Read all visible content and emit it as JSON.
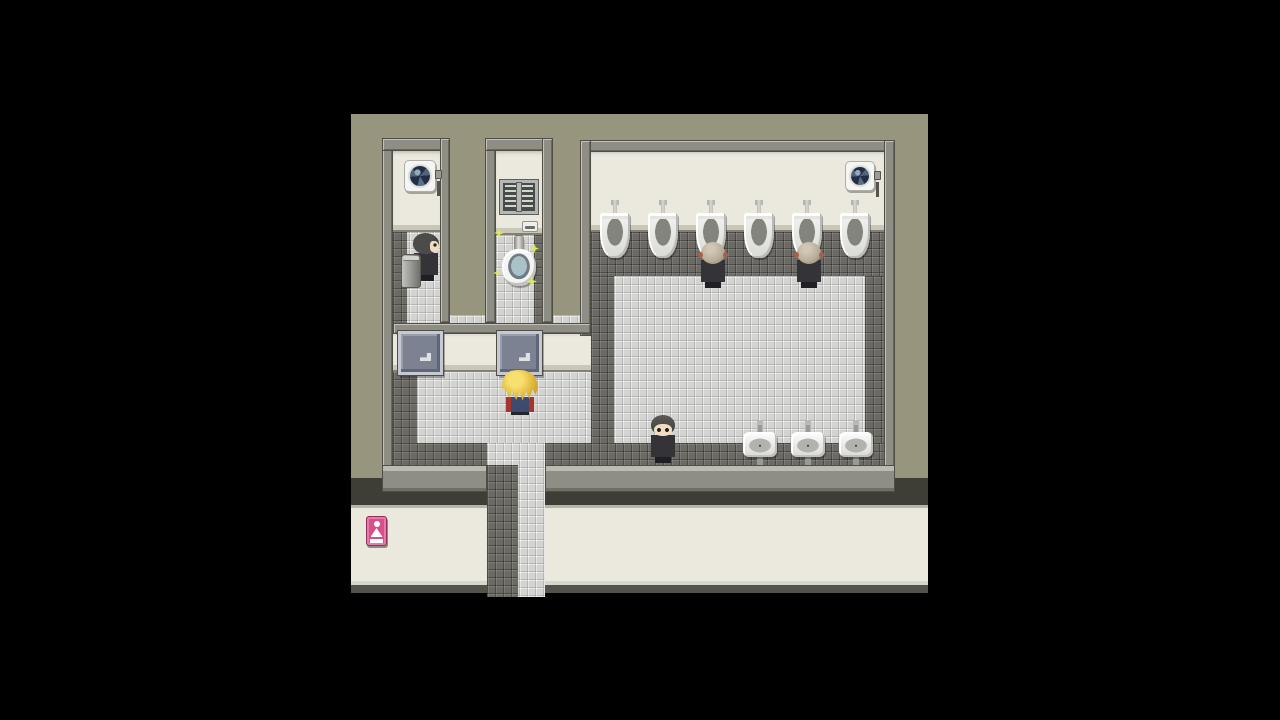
{
  "scene": {
    "viewport": {
      "x": 351,
      "y": 114,
      "w": 577,
      "h": 483
    },
    "palette": {
      "bg": "#000000",
      "olive": "#97957d",
      "wall": "#8f8e84",
      "cream": "#ebe8de",
      "creamShade": "#c9c6ba",
      "tileLight": "#d3d3d1",
      "tileDark": "#6b6a64",
      "doorFill": "#7d8292",
      "doorFrame": "#c6c9d1",
      "pink": "#d84f8a",
      "fixture": "#9b9b95",
      "skin": "#f2dcc2",
      "suit": "#333338",
      "hairBald": "#b6ab99",
      "playerHair": "#e2b93f",
      "playerSuit": "#3c4b6e",
      "accentRed": "#a8342e",
      "sparkle": "#dfe75a"
    },
    "elements": [
      {
        "type": "shadow-band",
        "name": "exterior-shadow",
        "x": 0,
        "y": 364,
        "w": 577,
        "h": 27,
        "interactable": false
      },
      {
        "type": "hall-wall",
        "name": "hallway-wall",
        "x": 0,
        "y": 391,
        "w": 577,
        "h": 80,
        "interactable": false
      },
      {
        "type": "hall-dark-strip",
        "name": "hallway-floor-edge",
        "x": 0,
        "y": 471,
        "w": 577,
        "h": 8,
        "interactable": false
      },
      {
        "type": "black-strip",
        "name": "hallway-darkness",
        "x": 0,
        "y": 479,
        "w": 577,
        "h": 4,
        "interactable": false
      },
      {
        "type": "tile-light",
        "name": "corridor-floor",
        "x": 136,
        "y": 329,
        "w": 58,
        "h": 154,
        "interactable": false
      },
      {
        "type": "tile-dark",
        "name": "corridor-floor-dark",
        "x": 136,
        "y": 351,
        "w": 31,
        "h": 132,
        "interactable": false
      },
      {
        "type": "tile-light",
        "name": "entry-area-floor",
        "x": 66,
        "y": 201,
        "w": 174,
        "h": 128,
        "interactable": false
      },
      {
        "type": "tile-dark",
        "name": "entry-floor-left-border",
        "x": 42,
        "y": 201,
        "w": 24,
        "h": 150,
        "interactable": false
      },
      {
        "type": "tile-dark",
        "name": "entry-floor-bottom-border",
        "x": 66,
        "y": 329,
        "w": 70,
        "h": 22,
        "interactable": false
      },
      {
        "type": "tile-dark",
        "name": "corridor-right-border",
        "x": 194,
        "y": 329,
        "w": 46,
        "h": 22,
        "interactable": false
      },
      {
        "type": "tile-light",
        "name": "stall1-floor",
        "x": 42,
        "y": 118,
        "w": 47,
        "h": 91,
        "interactable": false
      },
      {
        "type": "tile-dark",
        "name": "stall1-floor-border",
        "x": 42,
        "y": 118,
        "w": 14,
        "h": 91,
        "interactable": false
      },
      {
        "type": "tile-light",
        "name": "stall2-floor",
        "x": 145,
        "y": 121,
        "w": 46,
        "h": 88,
        "interactable": false
      },
      {
        "type": "tile-dark",
        "name": "stall2-floor-border",
        "x": 183,
        "y": 121,
        "w": 8,
        "h": 88,
        "interactable": false
      },
      {
        "type": "tile-dark",
        "name": "mainroom-floor-top-border",
        "x": 240,
        "y": 118,
        "w": 293,
        "h": 44,
        "interactable": false
      },
      {
        "type": "tile-dark",
        "name": "mainroom-floor-left-border",
        "x": 240,
        "y": 162,
        "w": 23,
        "h": 189,
        "interactable": false
      },
      {
        "type": "tile-dark",
        "name": "mainroom-floor-right-border",
        "x": 514,
        "y": 162,
        "w": 19,
        "h": 189,
        "interactable": false
      },
      {
        "type": "tile-dark",
        "name": "mainroom-floor-bottom-border",
        "x": 240,
        "y": 329,
        "w": 293,
        "h": 22,
        "interactable": false
      },
      {
        "type": "tile-light",
        "name": "mainroom-floor",
        "x": 263,
        "y": 162,
        "w": 251,
        "h": 167,
        "interactable": false
      },
      {
        "type": "cream",
        "name": "stall1-back-wall",
        "x": 42,
        "y": 37,
        "w": 47,
        "h": 81,
        "interactable": false
      },
      {
        "type": "cream",
        "name": "stall2-back-wall",
        "x": 145,
        "y": 37,
        "w": 46,
        "h": 84,
        "interactable": false
      },
      {
        "type": "cream",
        "name": "mainroom-back-wall",
        "x": 240,
        "y": 37,
        "w": 293,
        "h": 81,
        "interactable": false
      },
      {
        "type": "cream",
        "name": "stall-front-wall",
        "x": 42,
        "y": 218,
        "w": 198,
        "h": 40,
        "interactable": false
      },
      {
        "type": "wall",
        "name": "outer-wall-left",
        "x": 31,
        "y": 24,
        "w": 11,
        "h": 354,
        "interactable": false
      },
      {
        "type": "wall",
        "name": "stall1-wall-top",
        "x": 31,
        "y": 24,
        "w": 68,
        "h": 13,
        "interactable": false
      },
      {
        "type": "wall",
        "name": "stall1-wall-right",
        "x": 89,
        "y": 24,
        "w": 10,
        "h": 185,
        "interactable": false
      },
      {
        "type": "wall",
        "name": "stall2-wall-left",
        "x": 134,
        "y": 24,
        "w": 11,
        "h": 185,
        "interactable": false
      },
      {
        "type": "wall",
        "name": "stall2-wall-top",
        "x": 134,
        "y": 24,
        "w": 68,
        "h": 13,
        "interactable": false
      },
      {
        "type": "wall",
        "name": "stall2-wall-right",
        "x": 191,
        "y": 24,
        "w": 11,
        "h": 185,
        "interactable": false
      },
      {
        "type": "wall",
        "name": "mainroom-wall-top",
        "x": 229,
        "y": 26,
        "w": 315,
        "h": 12,
        "interactable": false
      },
      {
        "type": "wall",
        "name": "mainroom-wall-left",
        "x": 229,
        "y": 26,
        "w": 11,
        "h": 196,
        "interactable": false
      },
      {
        "type": "wall",
        "name": "mainroom-wall-right",
        "x": 533,
        "y": 26,
        "w": 11,
        "h": 352,
        "interactable": false
      },
      {
        "type": "wall",
        "name": "stall-front-wall-top",
        "x": 42,
        "y": 209,
        "w": 198,
        "h": 11,
        "interactable": false
      },
      {
        "type": "wall-s",
        "name": "bottom-wall-left",
        "x": 31,
        "y": 351,
        "w": 105,
        "h": 27,
        "interactable": false
      },
      {
        "type": "wall-s",
        "name": "bottom-wall-right",
        "x": 194,
        "y": 351,
        "w": 350,
        "h": 27,
        "interactable": false
      },
      {
        "type": "fan",
        "name": "hand-dryer-left",
        "x": 53,
        "y": 46,
        "w": 32,
        "h": 32,
        "interactable": false
      },
      {
        "type": "fan",
        "name": "hand-dryer-right",
        "x": 494,
        "y": 47,
        "w": 30,
        "h": 30,
        "interactable": false
      },
      {
        "type": "window",
        "name": "stall2-window",
        "x": 149,
        "y": 66,
        "w": 38,
        "h": 34,
        "interactable": false
      },
      {
        "type": "tp-holder",
        "name": "toilet-paper-holder",
        "x": 171,
        "y": 107,
        "w": 16,
        "h": 11,
        "interactable": false
      },
      {
        "type": "toilet",
        "name": "sparkling-toilet",
        "x": 151,
        "y": 122,
        "w": 34,
        "h": 50,
        "interactable": true
      },
      {
        "type": "sparkle",
        "name": "sparkle-icon",
        "x": 143,
        "y": 114,
        "w": 10,
        "h": 10,
        "interactable": false
      },
      {
        "type": "sparkle",
        "name": "sparkle-icon",
        "x": 179,
        "y": 130,
        "w": 9,
        "h": 9,
        "interactable": false
      },
      {
        "type": "sparkle",
        "name": "sparkle-icon",
        "x": 175,
        "y": 162,
        "w": 11,
        "h": 11,
        "interactable": false
      },
      {
        "type": "sparkle",
        "name": "sparkle-icon",
        "x": 142,
        "y": 155,
        "w": 8,
        "h": 8,
        "interactable": false
      },
      {
        "type": "urinal",
        "name": "urinal-1",
        "x": 249,
        "y": 86,
        "w": 30,
        "h": 58,
        "interactable": false
      },
      {
        "type": "urinal",
        "name": "urinal-2",
        "x": 297,
        "y": 86,
        "w": 30,
        "h": 58,
        "interactable": false
      },
      {
        "type": "urinal",
        "name": "urinal-3",
        "x": 345,
        "y": 86,
        "w": 30,
        "h": 58,
        "interactable": false
      },
      {
        "type": "urinal",
        "name": "urinal-4",
        "x": 393,
        "y": 86,
        "w": 30,
        "h": 58,
        "interactable": false
      },
      {
        "type": "urinal",
        "name": "urinal-5",
        "x": 441,
        "y": 86,
        "w": 30,
        "h": 58,
        "interactable": false
      },
      {
        "type": "urinal",
        "name": "urinal-6",
        "x": 489,
        "y": 86,
        "w": 30,
        "h": 58,
        "interactable": false
      },
      {
        "type": "sink",
        "name": "sink-1",
        "x": 392,
        "y": 311,
        "w": 34,
        "h": 40,
        "interactable": false
      },
      {
        "type": "sink",
        "name": "sink-2",
        "x": 440,
        "y": 311,
        "w": 34,
        "h": 40,
        "interactable": false
      },
      {
        "type": "sink",
        "name": "sink-3",
        "x": 488,
        "y": 311,
        "w": 34,
        "h": 40,
        "interactable": false
      },
      {
        "type": "chr npc-right",
        "name": "npc-stall-left",
        "x": 60,
        "y": 119,
        "w": 30,
        "h": 48,
        "interactable": true,
        "vars": {
          "--hair": "#4b4b49"
        }
      },
      {
        "type": "trash",
        "name": "trash-can",
        "x": 50,
        "y": 140,
        "w": 20,
        "h": 34,
        "interactable": false
      },
      {
        "type": "chr npc-back-bald",
        "name": "npc-at-urinal-left",
        "x": 347,
        "y": 126,
        "w": 30,
        "h": 48,
        "interactable": true
      },
      {
        "type": "chr npc-back-bald",
        "name": "npc-at-urinal-right",
        "x": 443,
        "y": 126,
        "w": 30,
        "h": 48,
        "interactable": true
      },
      {
        "type": "door",
        "name": "stall-door-1",
        "x": 47,
        "y": 217,
        "w": 45,
        "h": 44,
        "interactable": true
      },
      {
        "type": "door",
        "name": "stall-door-2",
        "x": 146,
        "y": 217,
        "w": 45,
        "h": 44,
        "interactable": true
      },
      {
        "type": "chr player-back",
        "name": "player-character",
        "x": 151,
        "y": 256,
        "w": 36,
        "h": 46,
        "interactable": true
      },
      {
        "type": "chr npc-down",
        "name": "npc-main-room",
        "x": 297,
        "y": 301,
        "w": 30,
        "h": 48,
        "interactable": true,
        "vars": {
          "--hair": "#5a5a56"
        }
      },
      {
        "type": "sign",
        "name": "women-restroom-sign",
        "x": 15,
        "y": 402,
        "w": 21,
        "h": 30,
        "interactable": true,
        "icon": "woman-figure-icon"
      }
    ]
  }
}
